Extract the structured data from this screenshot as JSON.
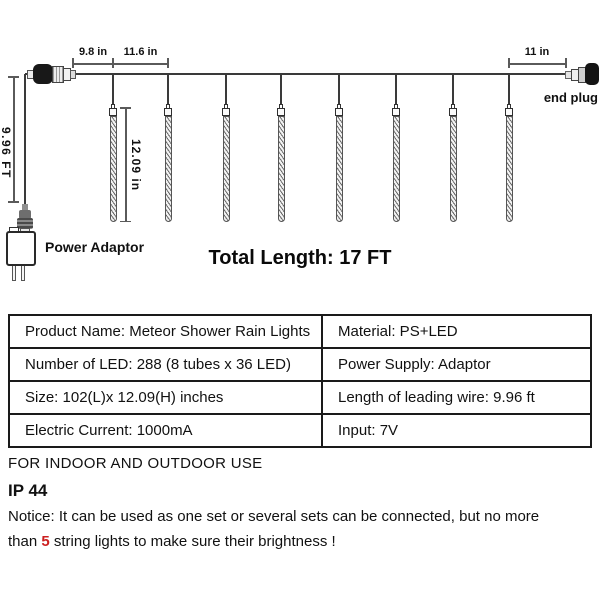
{
  "diagram": {
    "dims": {
      "lead_gap": "9.8 in",
      "tube_gap": "11.6 in",
      "end_gap": "11 in",
      "lead_wire_length": "9.96 FT",
      "tube_length": "12.09 in"
    },
    "labels": {
      "end_plug": "end plug",
      "power_adaptor": "Power Adaptor",
      "total_length": "Total Length: 17 FT"
    },
    "tube_count": 8
  },
  "spec_table": {
    "rows": [
      {
        "left": "Product Name: Meteor Shower Rain Lights",
        "right": "Material: PS+LED"
      },
      {
        "left": "Number of LED: 288 (8 tubes x 36 LED)",
        "right": "Power Supply: Adaptor"
      },
      {
        "left": "Size: 102(L)x 12.09(H) inches",
        "right": "Length of leading wire: 9.96 ft"
      },
      {
        "left": "Electric Current: 1000mA",
        "right": "Input: 7V"
      }
    ]
  },
  "footer": {
    "usage": "FOR INDOOR AND OUTDOOR USE",
    "ip_rating": "IP 44",
    "notice_line1": "Notice: It can be used as one set or several sets can be connected, but no more",
    "notice_line2_prefix": "than ",
    "notice_line2_highlight": "5",
    "notice_line2_suffix": " string lights to make sure their brightness !",
    "highlight_color": "#cc1f1f"
  }
}
